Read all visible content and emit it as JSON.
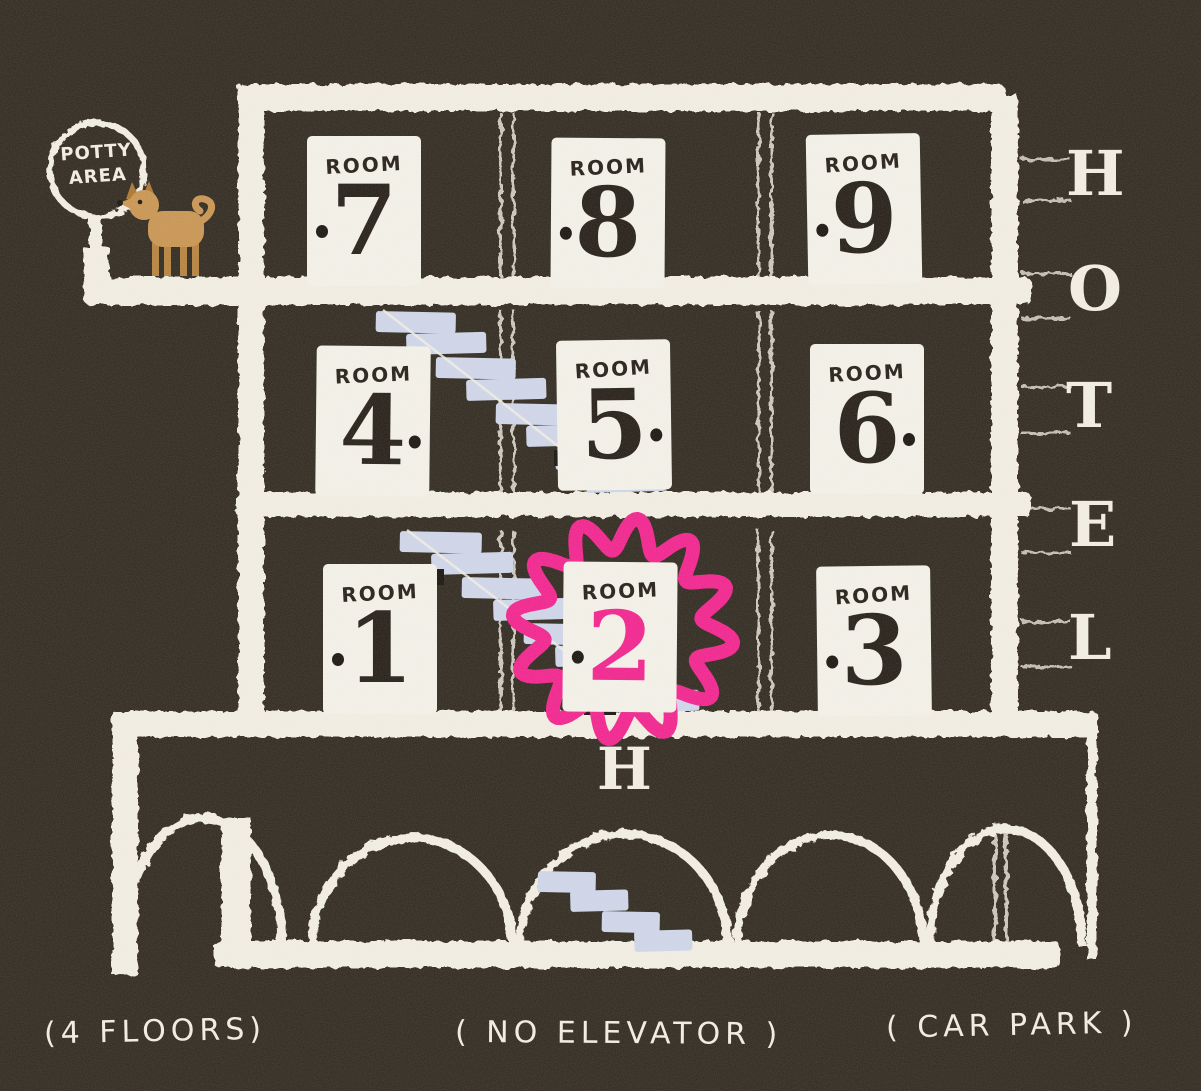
{
  "scene": {
    "background_color": "#2e271d",
    "ink_color": "#f0ece1",
    "stair_color": "#cdd4e8",
    "highlight_color": "#f0218c",
    "dog_color": "#c79350",
    "floors_drawn": 4
  },
  "hotel_sign": {
    "letters": [
      "H",
      "O",
      "T",
      "E",
      "L"
    ]
  },
  "potty_sign": {
    "lines": [
      "POTTY",
      "AREA"
    ]
  },
  "entrance_label": "H",
  "rooms": [
    {
      "label": "ROOM",
      "number": "1",
      "knob": "left",
      "highlighted": false
    },
    {
      "label": "ROOM",
      "number": "2",
      "knob": "left",
      "highlighted": true
    },
    {
      "label": "ROOM",
      "number": "3",
      "knob": "left",
      "highlighted": false
    },
    {
      "label": "ROOM",
      "number": "4",
      "knob": "right",
      "highlighted": false
    },
    {
      "label": "ROOM",
      "number": "5",
      "knob": "right",
      "highlighted": false
    },
    {
      "label": "ROOM",
      "number": "6",
      "knob": "right",
      "highlighted": false
    },
    {
      "label": "ROOM",
      "number": "7",
      "knob": "left",
      "highlighted": false
    },
    {
      "label": "ROOM",
      "number": "8",
      "knob": "left",
      "highlighted": false
    },
    {
      "label": "ROOM",
      "number": "9",
      "knob": "left",
      "highlighted": false
    }
  ],
  "captions": [
    {
      "text": "(4 FLOORS)"
    },
    {
      "text": "( NO ELEVATOR )"
    },
    {
      "text": "( CAR PARK )"
    }
  ]
}
